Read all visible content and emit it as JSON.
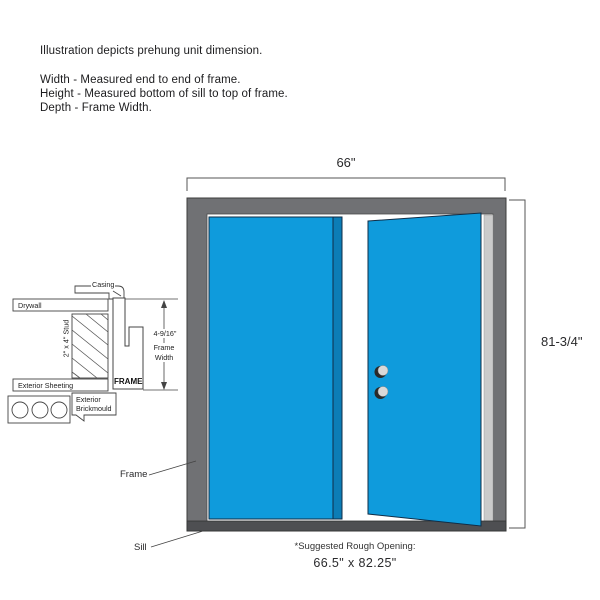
{
  "header": {
    "line1": "Illustration depicts prehung unit dimension.",
    "line2": "Width - Measured end to end of frame.",
    "line3": "Height - Measured bottom of sill to top of frame.",
    "line4": "Depth - Frame Width."
  },
  "dimensions": {
    "width": "66\"",
    "height": "81-3/4\"",
    "frame_depth_value": "4-9/16\"",
    "frame_depth_label_line1": "Frame",
    "frame_depth_label_line2": "Width"
  },
  "cross_section": {
    "casing": "Casing",
    "drywall": "Drywall",
    "stud": "2\" x 4\" Stud",
    "exterior_sheeting": "Exterior Sheeting",
    "frame": "FRAME",
    "brickmould_line1": "Exterior",
    "brickmould_line2": "Brickmould"
  },
  "callouts": {
    "frame": "Frame",
    "sill": "Sill"
  },
  "footer": {
    "rough_opening_label": "*Suggested Rough Opening:",
    "rough_opening_value": "66.5\" x 82.25\""
  },
  "colors": {
    "door_blue": "#0F9BDC",
    "door_edge_blue": "#0C7DB6",
    "frame_gray": "#707174",
    "sill_gray": "#4E4F52",
    "light_strip": "#CBCBCB",
    "handle_gray": "#D9D9D9"
  }
}
